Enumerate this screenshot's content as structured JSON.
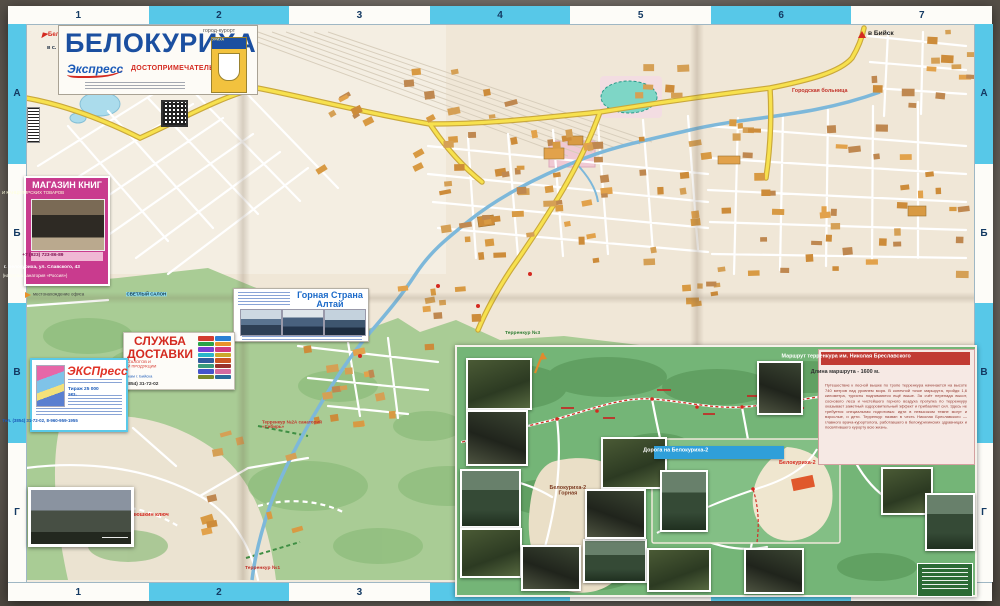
{
  "colors": {
    "band_cyan": "#57c8e8",
    "title_blue": "#1b4fa0",
    "accent_red": "#d42a20",
    "magenta": "#c93b8e",
    "map_green": "#a9cc95",
    "inset_green": "#74b577",
    "road_yellow": "#f7e14e"
  },
  "frame": {
    "top_numbers": [
      "1",
      "2",
      "3",
      "4",
      "5",
      "6",
      "7"
    ],
    "bottom_numbers": [
      "1",
      "2",
      "3",
      "4",
      "5",
      "6",
      "7"
    ],
    "left_letters": [
      "А",
      "Б",
      "В",
      "Г"
    ],
    "right_letters": [
      "А",
      "Б",
      "В",
      "Г"
    ]
  },
  "title_block": {
    "city": "БЕЛОКУРИХА",
    "tagline": "город-курорт",
    "subtitle": "ДОСТОПРИМЕЧАТЕЛЬНОСТИ",
    "brand": "Экспресс",
    "crest_label": "БЕЛОКУРИХА",
    "instagram": "@ instagram.com/express.biysk"
  },
  "map_labels": {
    "to_biysk": "в Бийск",
    "belokurikha2": "Белокуриха-2",
    "novotyryshkino": "в с. Новотырышкино",
    "hospital": "Городская больница",
    "dunyushkin": "Дунюшкин ключ",
    "terrenkur1": "Терренкур №1",
    "terrenkur2": "Терренкур №2А санаторий «Сибирь»",
    "terrenkur3": "Терренкур №3"
  },
  "ads": {
    "bookstore": {
      "title": "МАГАЗИН КНИГ",
      "subtitle": "И КАНЦЕЛЯРСКИХ ТОВАРОВ",
      "phone": "+7 (923) 723-86-89",
      "address": "г. Белокуриха, ул. Славского, 43",
      "address2": "(напротив санатория «Россия»)",
      "note": "местонахождение офиса",
      "note_hl": "СВЕТЛЫЙ САЛОН"
    },
    "delivery": {
      "title": "СЛУЖБА",
      "title2": "ДОСТАВКИ",
      "line1": "РЕКЛАМНЫХ КАТАЛОГОВ И",
      "line2": "ДРУГОЙ ПЕЧАТНОЙ ПРОДУКЦИИ",
      "line3": "по почтовым ящикам г. Бийска",
      "phone": "тел. (3854) 31-72-02"
    },
    "express": {
      "brand": "ЭКСПресс",
      "tirazh": "Тираж 25 000 экз.",
      "phone": "Тел. (3854) 31-72-02, 8-960-959-1955"
    },
    "altai": {
      "title": "Горная Страна",
      "title2": "Алтай"
    }
  },
  "inset": {
    "route_title": "Маршрут терренкура  им. Николая Бреславского",
    "route_length": "Длина маршрута - 1600 м.",
    "route_text": "Путешествие к лесной вышке по тропе терренкура начинается на высоте 740 метров над уровнем моря. В конечной точке маршрута, пройдя 1,6 километра, туристы поднимаются ещё выше. За счёт перепада высот, соснового леса и чистейшего горного воздуха прогулка по терренкуру оказывает заметный оздоровительный эффект и прибавляет сил. Здесь не требуется специальная подготовка: идти в невысоком темпе могут и взрослые, и дети. Терренкур назван в честь Николая Бреславского — главного врача-курортолога, работавшего в белокурихинских здравницах и посвятившего курорту всю жизнь.",
    "road_title": "Дорога на Белокуриха-2",
    "bel2_gornaya": "Белокуриха-2",
    "bel2_gornaya2": "Горная",
    "bel2": "Белокуриха-2"
  }
}
